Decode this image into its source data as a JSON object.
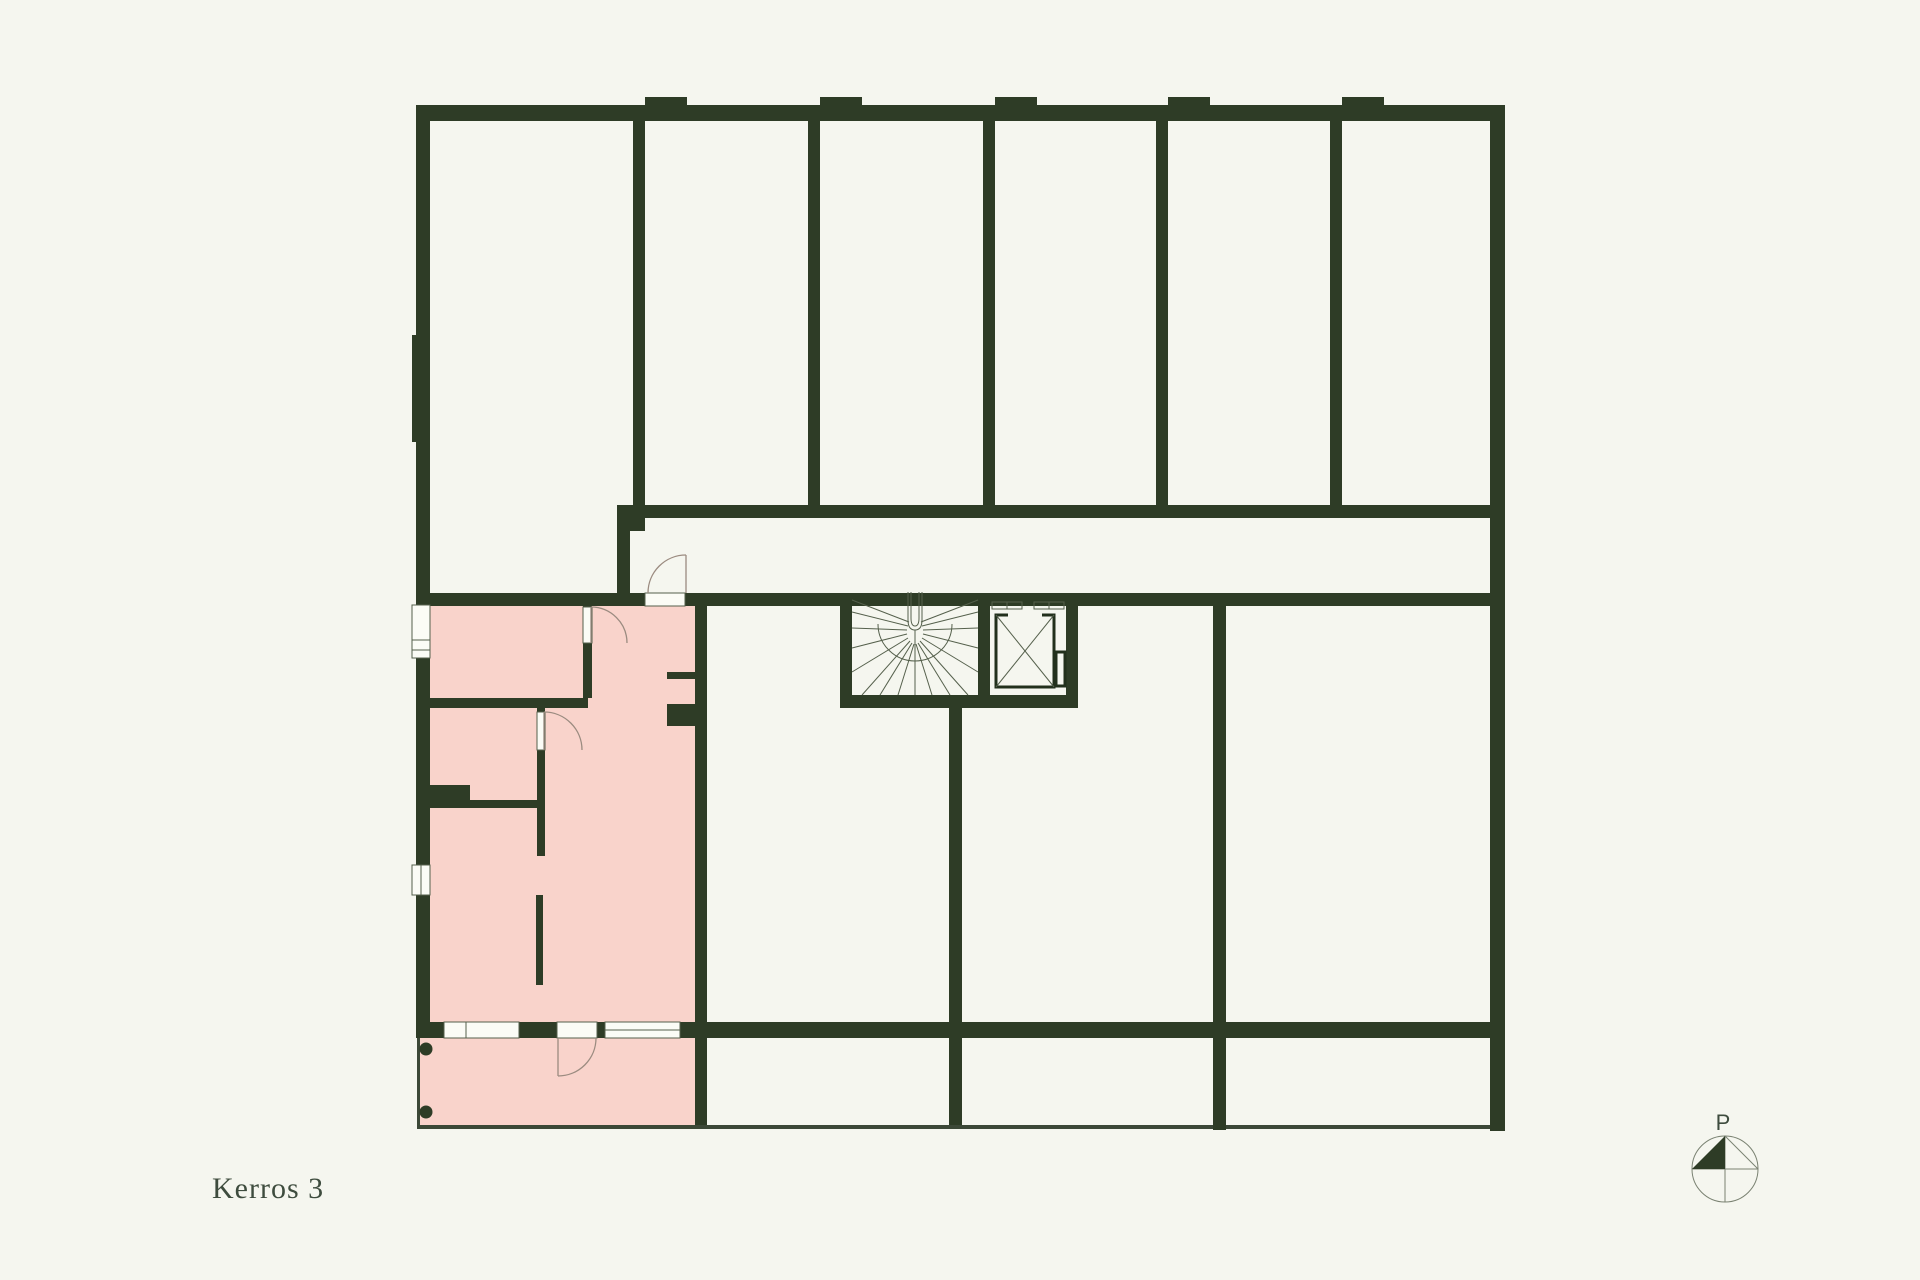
{
  "title": "Kerros 3",
  "compass": {
    "label": "P"
  },
  "colors": {
    "background": "#f5f6ef",
    "wall": "#2e3c26",
    "highlight": "#f9d3cb",
    "thin": "#3c4837",
    "frame": "#55604c",
    "arc": "#9b8b80",
    "elevcar": "#22301c",
    "compass": "#7a8272",
    "text": "#3e4c3e"
  }
}
